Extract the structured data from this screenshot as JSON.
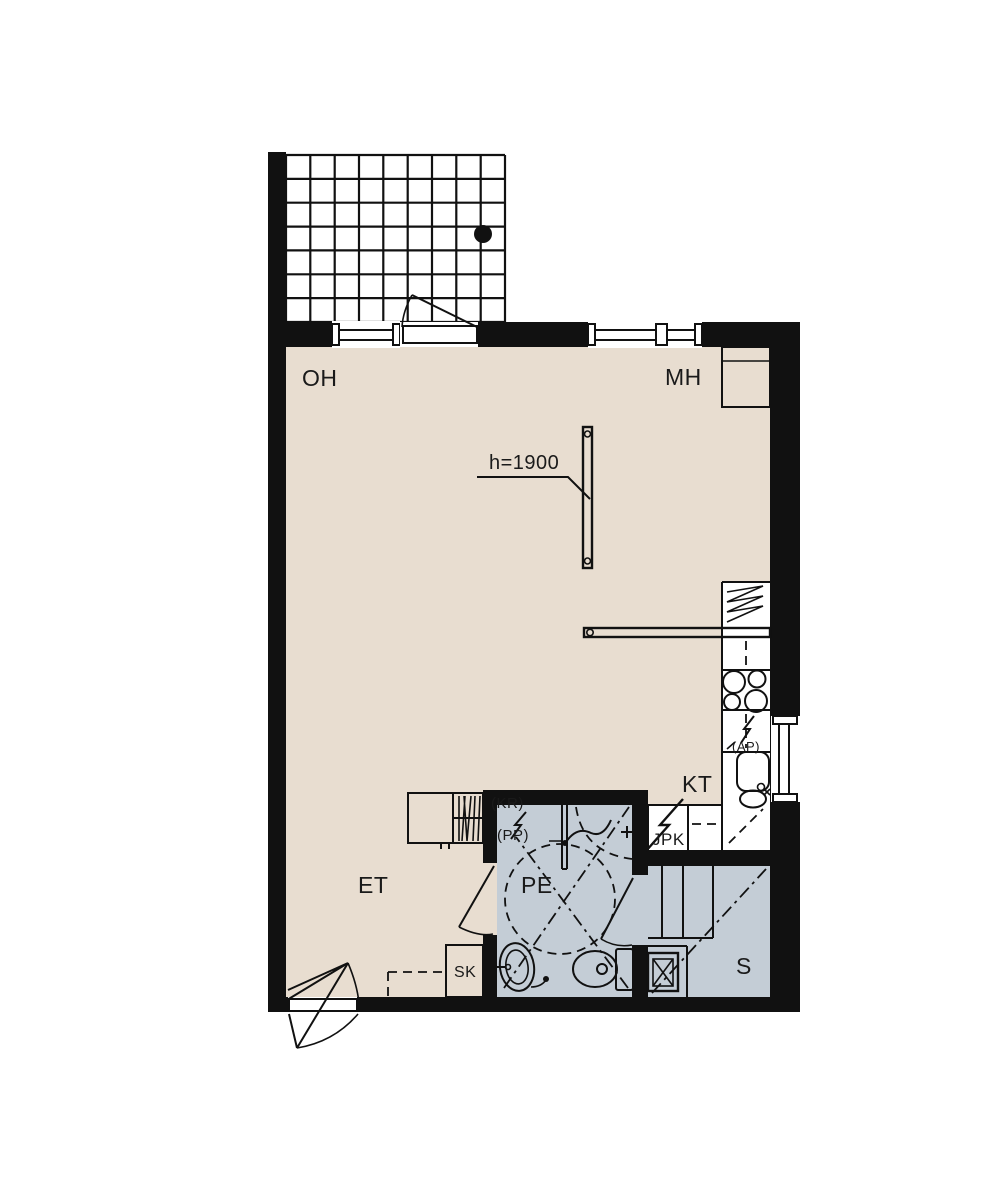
{
  "plan": {
    "title": "apartment-floor-plan",
    "labels": {
      "oh": "OH",
      "mh": "MH",
      "kt": "KT",
      "et": "ET",
      "pe": "PE",
      "s": "S",
      "sk": "SK",
      "jpk": "JPK",
      "kr": "(KR)",
      "pp": "(PP)",
      "ap": "(AP)",
      "height": "h=1900"
    },
    "colors": {
      "wall": "#111111",
      "floor_dry": "#e8ddd0",
      "floor_wet": "#c4cdd6",
      "line": "#1a1a1a",
      "background": "#ffffff"
    },
    "fixtures": [
      "balcony-tile-grid",
      "floor-drain-dot",
      "balcony-door",
      "window",
      "glass-partition",
      "kitchen-counter",
      "fridge-symbol",
      "stove-burners",
      "kitchen-sink",
      "appliance-reservation-bolt",
      "washbasin",
      "toilet",
      "shower-head",
      "turning-circle",
      "sauna-benches",
      "sauna-stove",
      "cleaning-closet",
      "coat-rack",
      "wardrobe",
      "entrance-door"
    ]
  }
}
